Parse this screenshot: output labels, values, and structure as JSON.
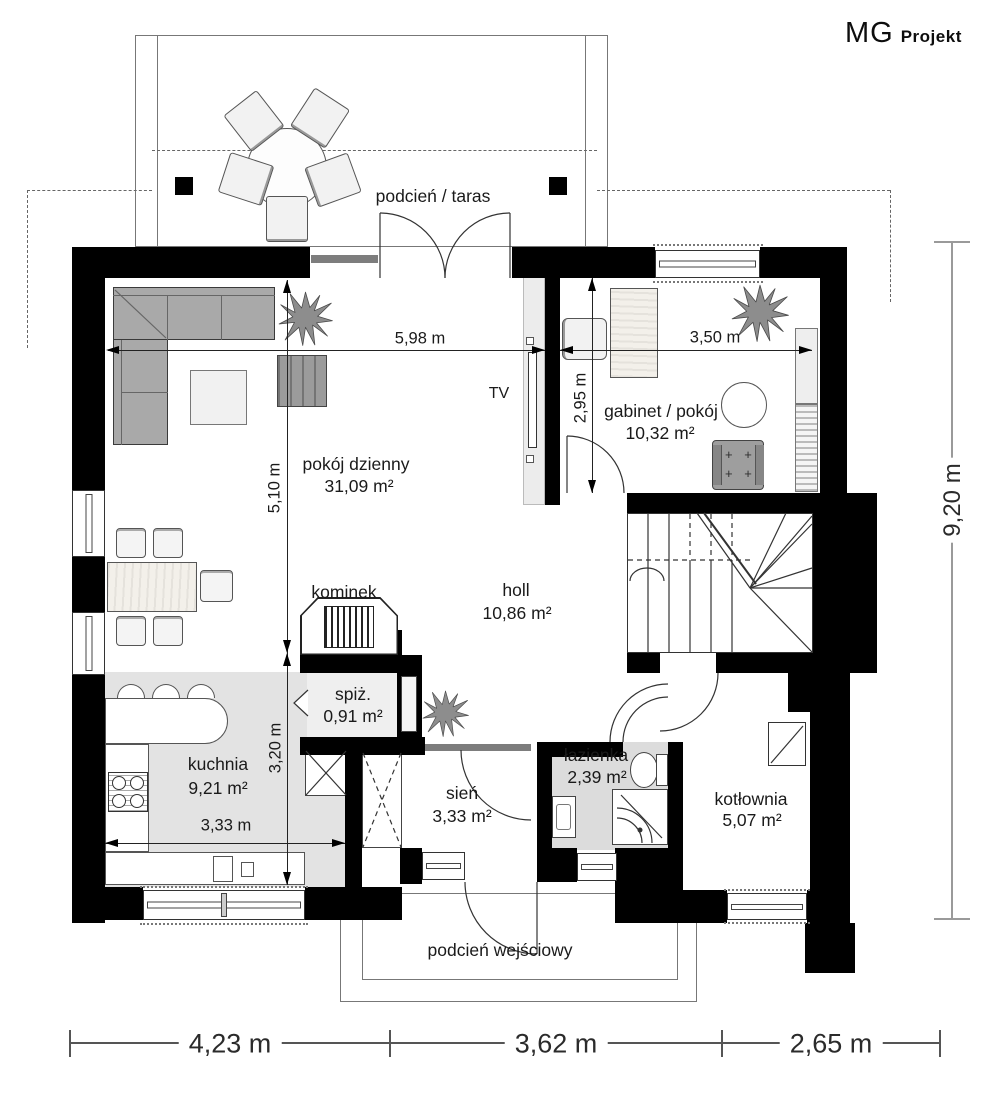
{
  "brand": {
    "mg": "MG",
    "projekt": "Projekt"
  },
  "rooms": {
    "taras": {
      "label": "podcień / taras"
    },
    "pokoj_dzienny": {
      "label": "pokój dzienny",
      "area": "31,09 m²"
    },
    "gabinet": {
      "label": "gabinet / pokój",
      "area": "10,32 m²"
    },
    "holl": {
      "label": "holl",
      "area": "10,86 m²"
    },
    "kominek": {
      "label": "kominek"
    },
    "spiz": {
      "label": "spiż.",
      "area": "0,91 m²"
    },
    "kuchnia": {
      "label": "kuchnia",
      "area": "9,21 m²"
    },
    "sien": {
      "label": "sień",
      "area": "3,33 m²"
    },
    "lazienka": {
      "label": "łazienka",
      "area": "2,39 m²"
    },
    "kotlownia": {
      "label": "kotłownia",
      "area": "5,07 m²"
    },
    "wejscie": {
      "label": "podcień wejściowy"
    }
  },
  "fixtures": {
    "tv": "TV"
  },
  "dimensions": {
    "width_salon": "5,98 m",
    "width_gabinet": "3,50 m",
    "depth_gabinet": "2,95 m",
    "depth_salon": "5,10 m",
    "depth_kuchnia": "3,20 m",
    "width_kuchnia": "3,33 m",
    "total_depth": "9,20 m",
    "bottom": [
      "4,23 m",
      "3,62 m",
      "2,65 m"
    ]
  },
  "colors": {
    "wall": "#000000",
    "kitchen_floor": "#e3e3e3",
    "bath_floor": "#dcdcdc",
    "furniture_gray": "#a9a9a9",
    "dim_line_gray": "#9a9a9a"
  }
}
